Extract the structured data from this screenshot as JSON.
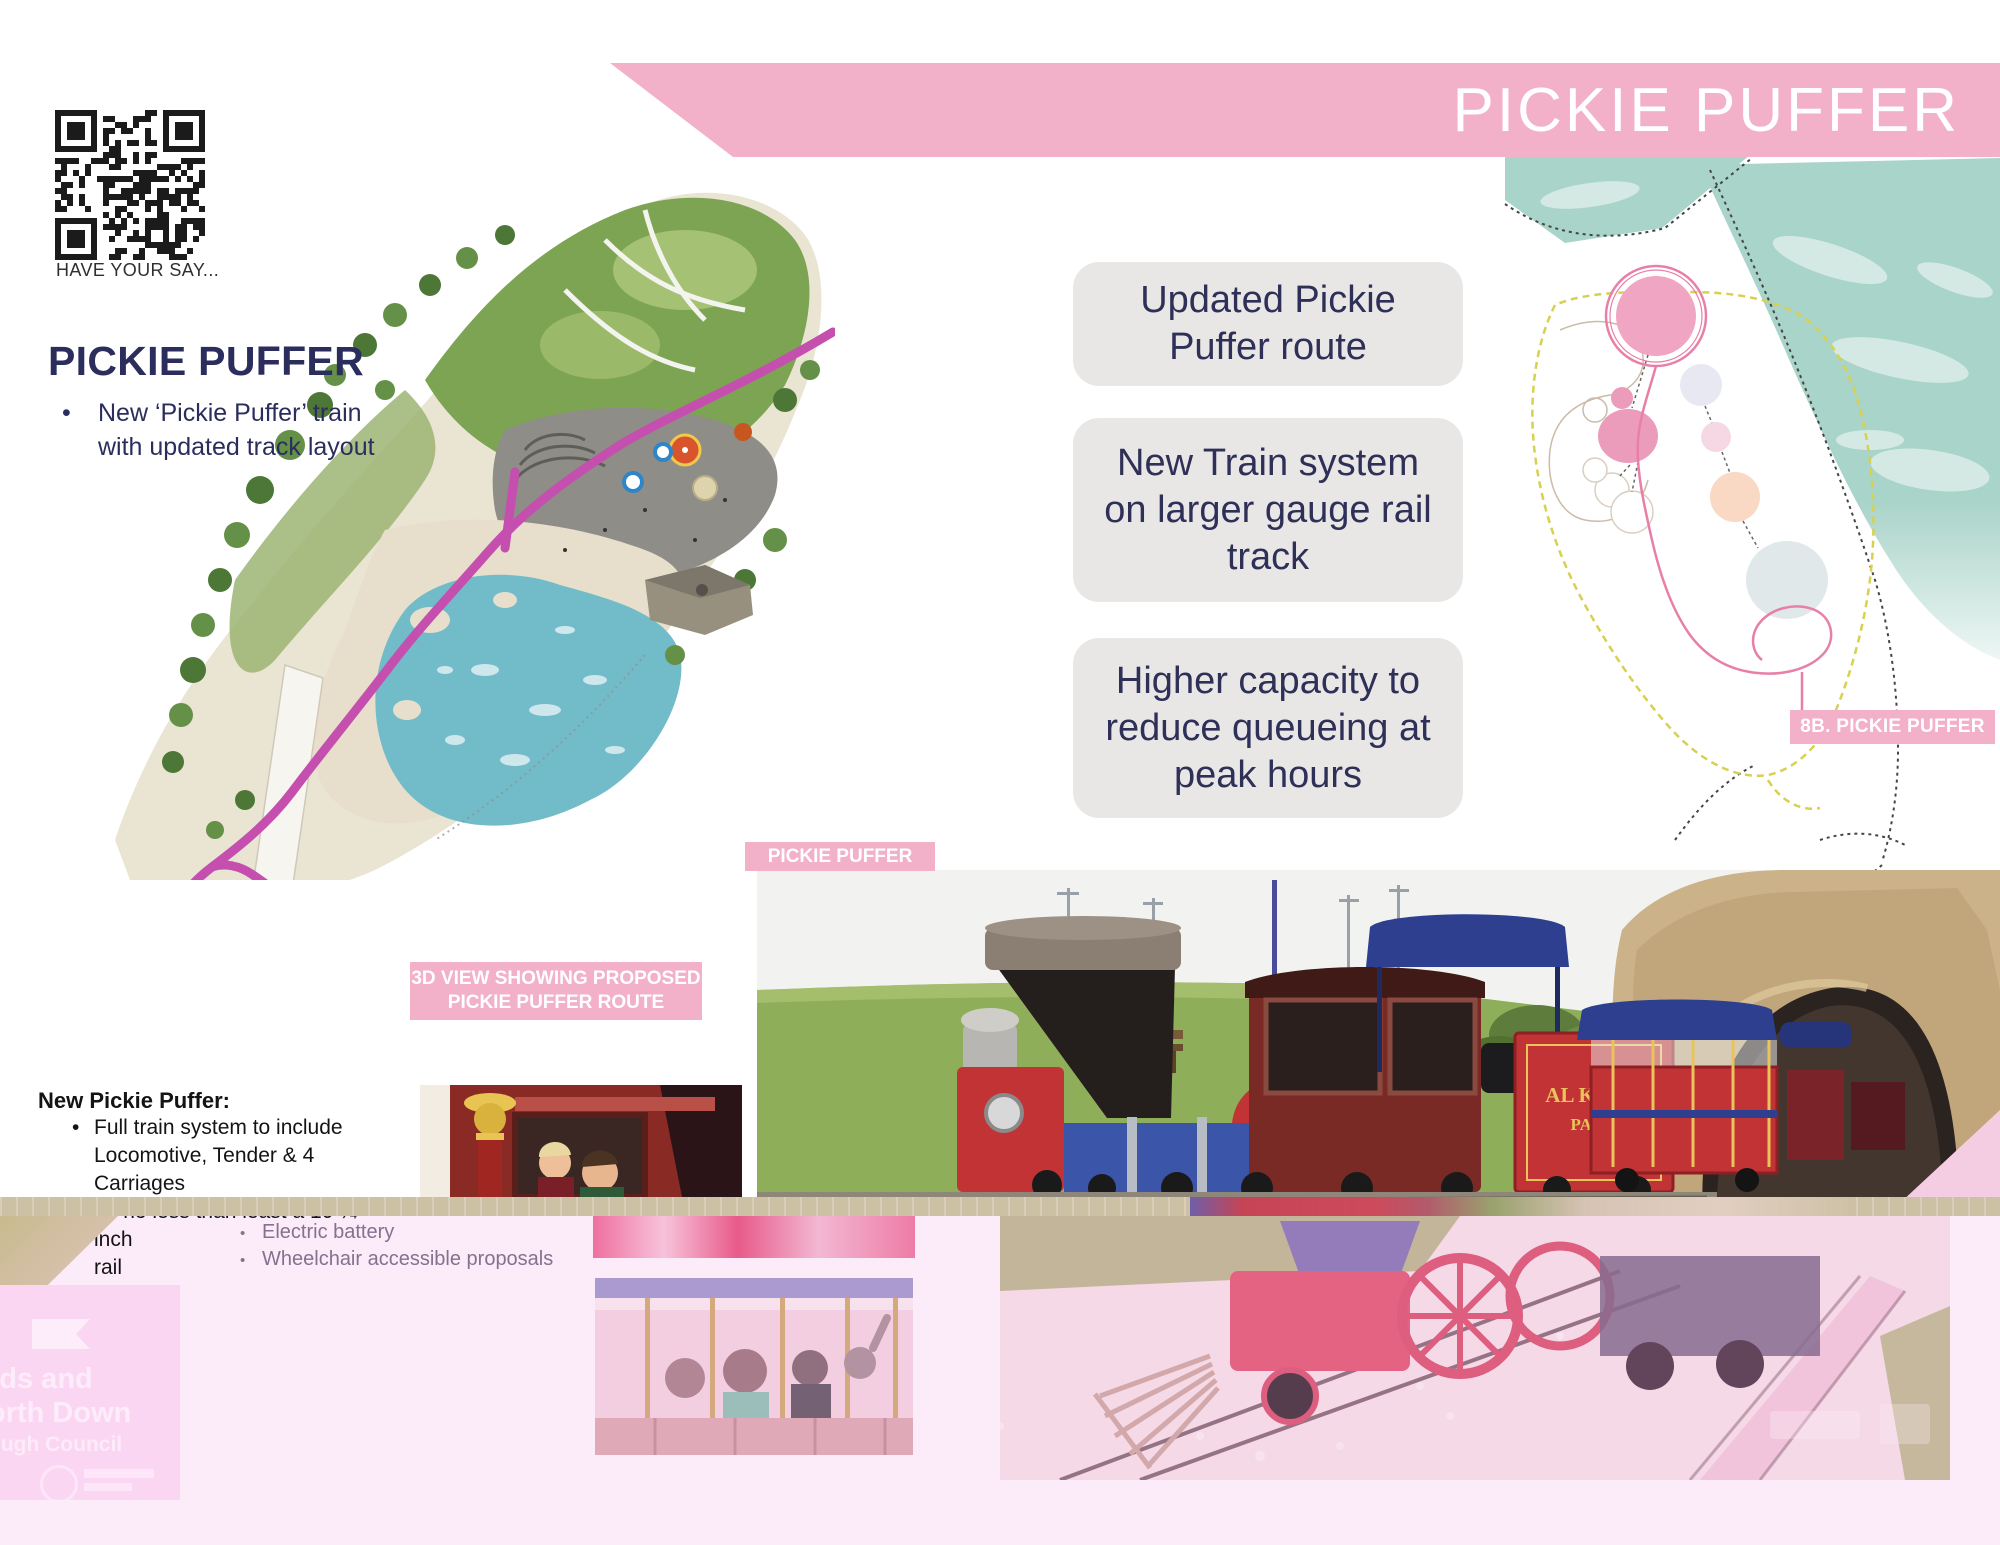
{
  "colors": {
    "banner_pink": "#f2b1c9",
    "navy_text": "#2b2d5c",
    "info_box_bg": "#e8e7e6",
    "tan_bar": "#cdc1a5",
    "route_magenta": "#c44fae",
    "map_route_pink": "#e87fa8",
    "water_teal": "#a9d4c9",
    "bottom_overlay_pink": "#fcebf9",
    "logo_box_pink": "#fbd6f3",
    "extra_bullet_purple": "#85718f"
  },
  "header": {
    "banner_title": "PICKIE PUFFER"
  },
  "qr": {
    "caption": "HAVE YOUR SAY..."
  },
  "intro": {
    "heading": "PICKIE PUFFER",
    "bullet_line1": "New ‘Pickie Puffer’ train",
    "bullet_line2": "with updated track layout"
  },
  "info_boxes": [
    {
      "text": "Updated Pickie Puffer route"
    },
    {
      "text": "New Train system on larger gauge rail track"
    },
    {
      "text": "Higher capacity to reduce queueing at peak hours"
    }
  ],
  "tags": {
    "photo": "PICKIE PUFFER",
    "view_line1": "3D VIEW SHOWING PROPOSED",
    "view_line2": "PICKIE PUFFER ROUTE",
    "map": "8B. PICKIE PUFFER"
  },
  "details": {
    "heading": "New Pickie Puffer:",
    "bullets": [
      "Full train system to include",
      "Locomotive, Tender & 4 Carriages",
      "on no less than least a 10 ¼ inch",
      "rail"
    ],
    "extra_bullets": [
      "Electric battery",
      "Wheelchair accessible proposals"
    ]
  },
  "train_photo": {
    "tender_line1": "AL KHOR",
    "tender_line2": "PARK"
  },
  "council_logo": {
    "line1": "rds and",
    "line2": "orth Down",
    "line3": "ough Council"
  }
}
